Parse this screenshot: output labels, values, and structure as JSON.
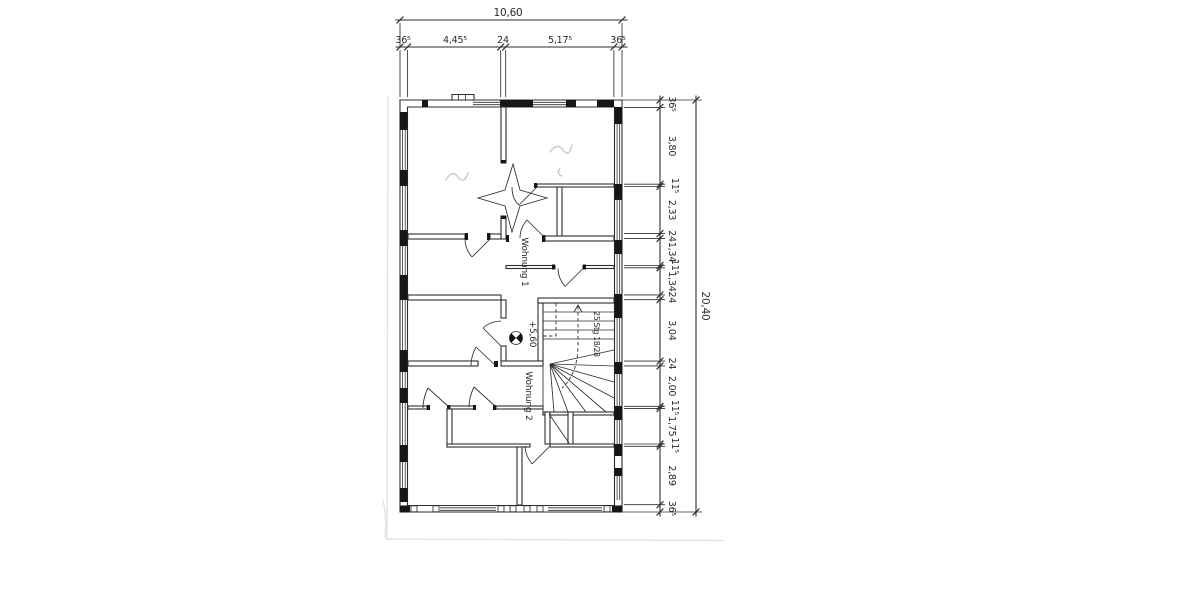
{
  "drawing": {
    "type": "architectural-floor-plan-scan",
    "labels": {
      "apartment1": "Wohnung 1",
      "apartment2": "Wohnung 2",
      "level": "+5,60",
      "stairs": "25 Stg 18/28"
    },
    "dims": {
      "top": {
        "overall": "10,60",
        "segments": [
          "36⁵",
          "4,45⁵",
          "24",
          "5,17⁵",
          "36⁵"
        ]
      },
      "right": {
        "overall": "20,40",
        "segments": [
          "36⁵",
          "3,80",
          "11⁵",
          "2,33",
          "24",
          "1,34",
          "11⁵",
          "1,34",
          "24",
          "3,04",
          "24",
          "2,00",
          "11⁵",
          "1,75",
          "11⁵",
          "2,89",
          "36⁵"
        ]
      }
    },
    "colors": {
      "ink": "#2e2e2e",
      "wall_fill": "#161616",
      "pencil": "#c7c7c7",
      "paper": "#ffffff"
    }
  }
}
